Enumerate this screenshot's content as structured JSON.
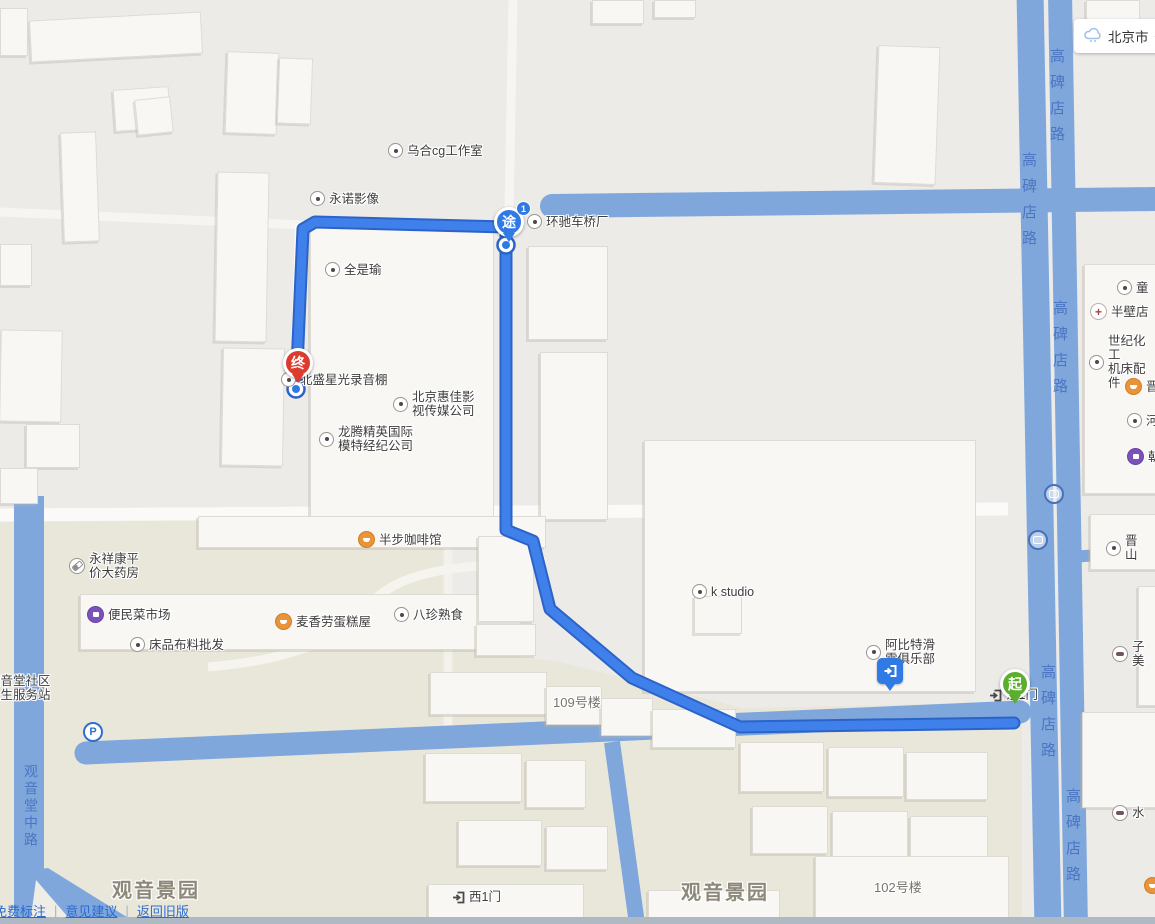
{
  "chrome": {
    "city_selector": {
      "city": "北京市"
    },
    "footer_links": [
      {
        "label": "免费标注"
      },
      {
        "label": "意见建议"
      },
      {
        "label": "返回旧版"
      }
    ],
    "footer_separator": "|"
  },
  "roads": {
    "gaobeidianlu": "高碑店路",
    "guanyintangzhonglu": "观音堂中路"
  },
  "areas": {
    "guanyinjingyuan": "观音景园"
  },
  "building_labels": {
    "b109": "109号楼",
    "b102": "102号楼"
  },
  "route_markers": {
    "start": "起",
    "via": "途",
    "via_badge": "1",
    "end": "终"
  },
  "pois": [
    {
      "icon": "poi-dot",
      "label": "乌合cg工作室"
    },
    {
      "icon": "poi-dot",
      "label": "永诺影像"
    },
    {
      "icon": "poi-dot",
      "label": "环驰车桥厂"
    },
    {
      "icon": "poi-dot",
      "label": "全是瑜"
    },
    {
      "icon": "poi-dot",
      "label": "北盛星光录音棚"
    },
    {
      "icon": "poi-dot",
      "label": "北京惠佳影\n视传媒公司"
    },
    {
      "icon": "poi-dot",
      "label": "龙腾精英国际\n模特经纪公司"
    },
    {
      "icon": "food-icon",
      "label": "半步咖啡馆"
    },
    {
      "icon": "pharmacy-icon",
      "label": "永祥康平\n价大药房"
    },
    {
      "icon": "shopping-icon",
      "label": "便民菜市场"
    },
    {
      "icon": "food-icon",
      "label": "麦香劳蛋糕屋"
    },
    {
      "icon": "poi-dot",
      "label": "八珍熟食"
    },
    {
      "icon": "poi-dot",
      "label": "床品布料批发"
    },
    {
      "icon": "none",
      "label": "观音堂社区\n卫生服务站"
    },
    {
      "icon": "poi-dot",
      "label": "k studio"
    },
    {
      "icon": "poi-dot",
      "label": "阿比特滑\n雪俱乐部"
    },
    {
      "icon": "poi-dot",
      "label": "童"
    },
    {
      "icon": "hospital-icon",
      "label": "半壁店"
    },
    {
      "icon": "poi-dot",
      "label": "世纪化工\n机床配件"
    },
    {
      "icon": "food-icon",
      "label": "晋"
    },
    {
      "icon": "poi-dot",
      "label": "河"
    },
    {
      "icon": "shopping-icon",
      "label": "朝"
    },
    {
      "icon": "poi-dot",
      "label": "晋\n山"
    },
    {
      "icon": "car-icon",
      "label": "子\n美"
    },
    {
      "icon": "car-icon",
      "label": "水"
    },
    {
      "icon": "gate-icon",
      "label": "西1门"
    },
    {
      "icon": "gate-icon",
      "label": "东1门"
    }
  ],
  "colors": {
    "map_gray": "#ECEBE8",
    "residential_beige": "#E9E7DA",
    "road_blue": "#7FA7DC",
    "route_blue": "#3F80EA",
    "route_casing": "#2B63C8",
    "start_green": "#5BAE2E",
    "via_blue": "#2F7AE5",
    "end_red": "#DC3B2F",
    "link_blue": "#2a6bd0"
  }
}
